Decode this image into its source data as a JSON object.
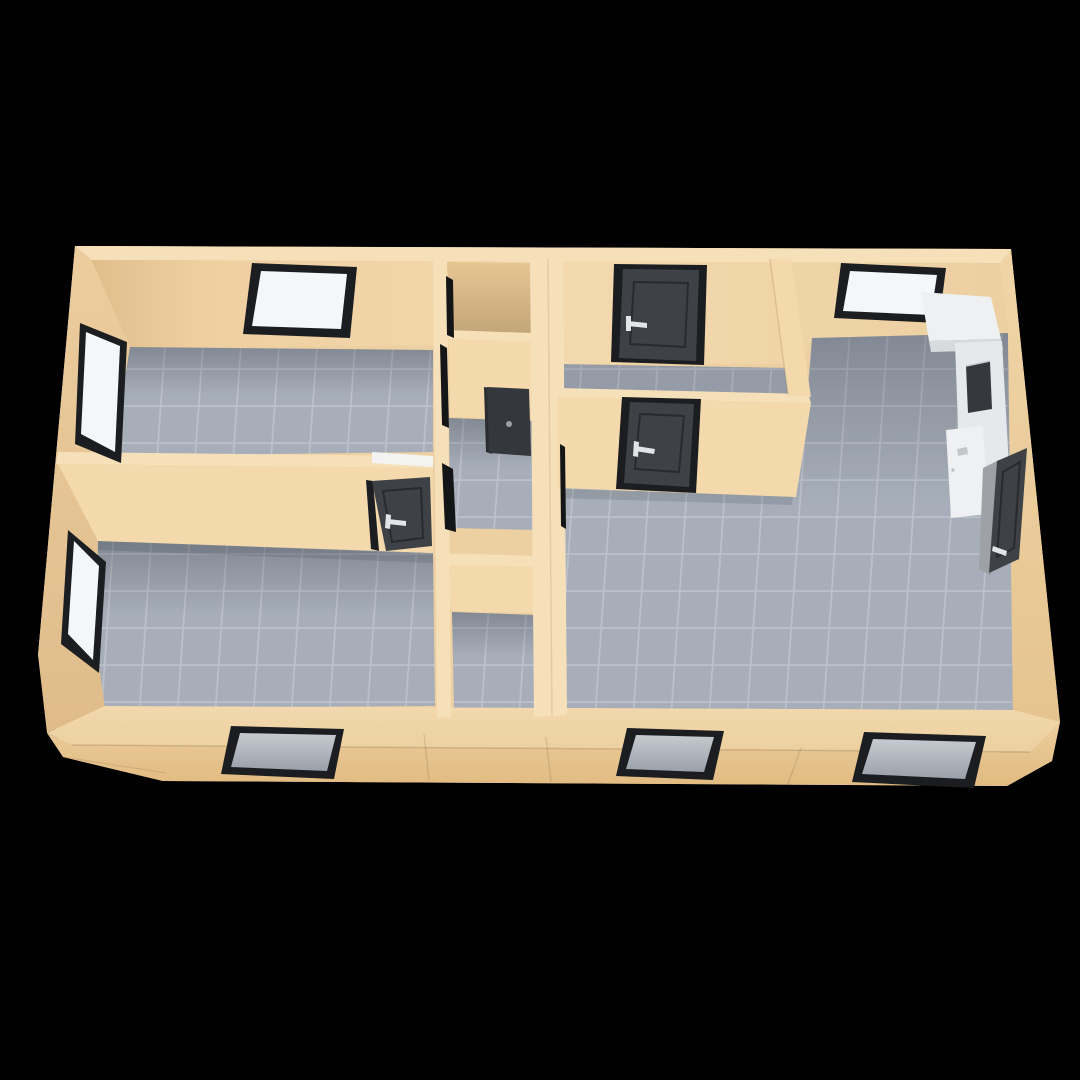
{
  "scene": {
    "type": "3d-floor-plan-render",
    "view": "elevated front perspective dollhouse cutaway, no visible text or UI controls",
    "background": "#000000"
  },
  "colors": {
    "background": "#000000",
    "wallOuter": "#ecd0a2",
    "wallTop": "#f6e0ba",
    "wallLit": "#f3d9ac",
    "wallBack": "#efd3a6",
    "wallInnerLeft": "#e6c495",
    "closet": "#e6c693",
    "floor": "#a7aeb9",
    "grout": "#cdd1d7",
    "door": "#3e4146",
    "doorFrame": "#1b1d20",
    "doorRecess": "#34373b",
    "handle": "#e2e5e8",
    "glassWhite": "#f4f6f8",
    "glassGray": "#b5bac1",
    "counter": "#eef0f2",
    "counterSide": "#e6e9ec",
    "counterShade": "#d8dbde",
    "appliance": "#35383c",
    "gap": "#141517",
    "lintel": "#f3f3f1"
  },
  "building": {
    "shell": "single-storey apartment, beige walls, gray tiled floors",
    "rooms": [
      {
        "id": "bedroom-1",
        "position": "top-left",
        "floor": "tile",
        "windows": 2
      },
      {
        "id": "bedroom-2",
        "position": "bottom-left",
        "floor": "tile",
        "windows": 2,
        "doors": 1
      },
      {
        "id": "closet",
        "position": "center-top",
        "floor": "hidden"
      },
      {
        "id": "bathroom",
        "position": "center-middle",
        "floor": "tile",
        "doors": 1
      },
      {
        "id": "corridor",
        "position": "center-bottom",
        "floor": "tile"
      },
      {
        "id": "entry-hall",
        "position": "middle",
        "floor": "tile",
        "doors": 2
      },
      {
        "id": "living-kitchen",
        "position": "right",
        "floor": "tile",
        "windows": 3,
        "doors": 1,
        "furniture": [
          "kitchen-counter",
          "built-in-appliance",
          "base-cabinet"
        ]
      }
    ],
    "totals": {
      "windows": 7,
      "door_panels": 5,
      "open_doorway_gaps": 4
    }
  }
}
